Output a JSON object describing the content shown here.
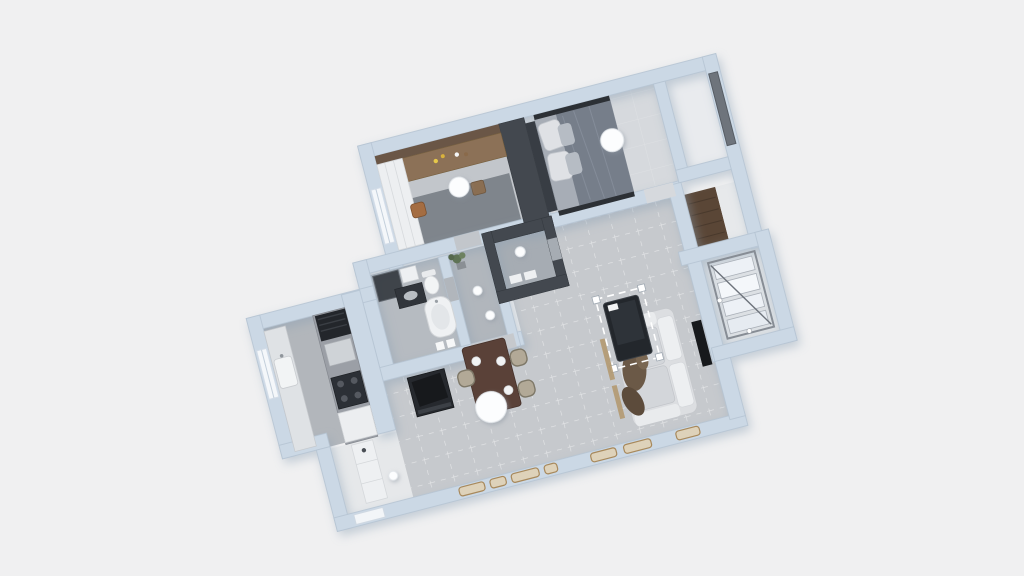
{
  "scene": {
    "description": "3D overhead render of a one-bedroom apartment floor plan, rotated, on a light gray background",
    "view_rotation_deg": -14.5,
    "background_color": "#f0f0f1",
    "selection": {
      "object": "coffee-table",
      "style": "white dashed outline with corner handles"
    }
  },
  "palette": {
    "wall": "#cbd8e5",
    "wall_edge": "#b4c3d2",
    "dark_wall": "#43484f",
    "wood_dark": "#6a5646",
    "wood_mid": "#8c7157",
    "wood_floor": "#5a4636",
    "table_brown": "#5a4138",
    "sofa_light": "#dcdee1",
    "duvet_gray": "#767e8a",
    "appliance_dark": "#2c3036",
    "tv_black": "#17191c",
    "gold_trim": "#a8895c",
    "light_fixture": "#fcfdfe",
    "person_brown": "#6b5947",
    "plant_green": "#5f7355"
  },
  "rooms": [
    {
      "name": "study-dressing-room",
      "floor_color": "#c2c6cb",
      "furniture": [
        "wood-panel-wall",
        "wood-desk",
        "desk-stool",
        "white-wardrobe",
        "dark-rug",
        "orange-chair",
        "ceiling-light"
      ]
    },
    {
      "name": "bedroom",
      "floor_color": "#d6d9dd",
      "furniture": [
        "double-bed",
        "pillows",
        "gray-duvet",
        "dark-headboard-wall",
        "window",
        "ceiling-light"
      ]
    },
    {
      "name": "wardrobe-strip",
      "floor_color": "#e9ebee",
      "furniture": []
    },
    {
      "name": "shower-room",
      "floor_color": "#a6acb3",
      "furniture": [
        "dark-tiled-walls",
        "ceiling-light"
      ]
    },
    {
      "name": "hallway-wc",
      "floor_color": "#b1b6bc",
      "furniture": [
        "potted-plant",
        "ceiling-light",
        "ceiling-light"
      ]
    },
    {
      "name": "bathroom",
      "floor_color": "#b6bbc1",
      "furniture": [
        "shower-glass",
        "washer-cabinet",
        "dark-vanity",
        "toilet",
        "bathtub"
      ]
    },
    {
      "name": "kitchen",
      "floor_color": "#b2b6bb",
      "furniture": [
        "left-counter-with-sink",
        "right-counter",
        "range-hood",
        "cooktop-ovens",
        "gas-stove",
        "white-fridge",
        "window"
      ]
    },
    {
      "name": "entry-hall",
      "floor_color": "#e6e8ea",
      "furniture": [
        "shoe-cabinet",
        "ceiling-light",
        "entry-door"
      ]
    },
    {
      "name": "living-dining-room",
      "floor_color": "#c6c9cd",
      "furniture": [
        "dining-table",
        "dining-chair",
        "dining-chair",
        "dining-chair",
        "plates",
        "large-ceiling-light",
        "tv-sideboard",
        "coffee-table-selected",
        "sofa",
        "person-figure",
        "wall-tv",
        "floor-window-vents"
      ]
    },
    {
      "name": "balcony",
      "floor_color": "#dce0e4",
      "furniture": [
        "glass-drying-rack"
      ]
    },
    {
      "name": "storage-niche",
      "floor_color": "#5a4636",
      "furniture": [
        "wood-plank-floor"
      ]
    }
  ],
  "lights": {
    "count": 7,
    "color": "#fcfdfe"
  }
}
